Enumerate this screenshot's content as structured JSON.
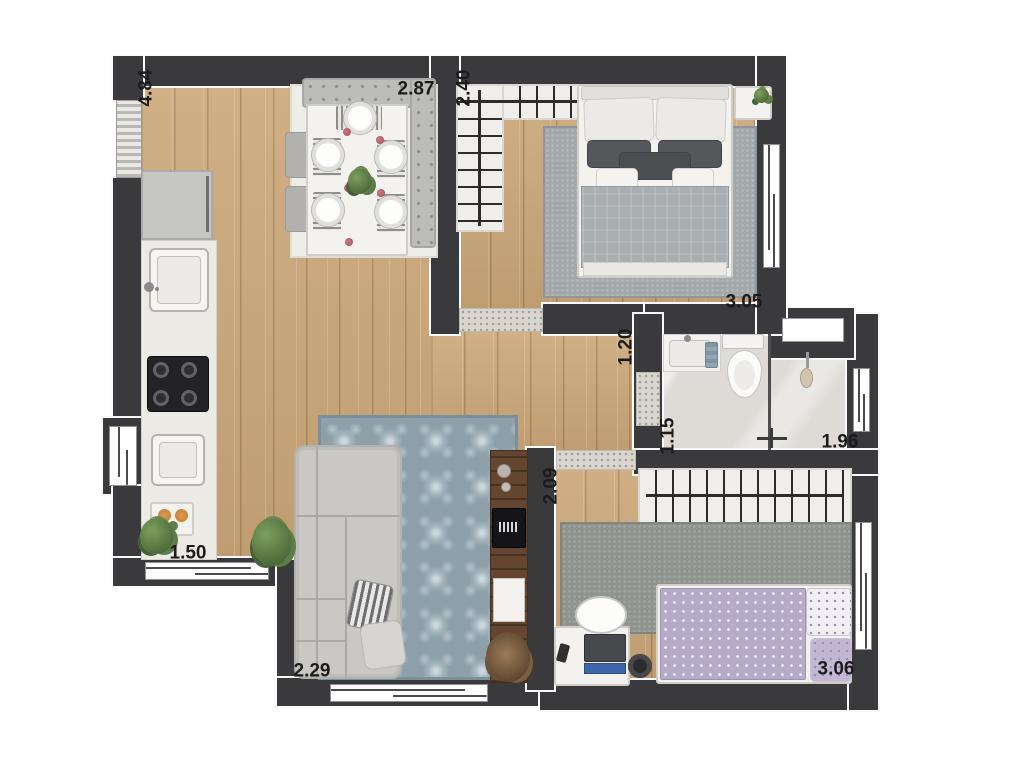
{
  "meta": {
    "type": "apartment floor plan render",
    "rooms": [
      "kitchen-dining",
      "bedroom-1",
      "bathroom",
      "living-room",
      "bedroom-2",
      "hall"
    ]
  },
  "colors": {
    "wall": "#3a3a3c",
    "wood": "#cda97c",
    "bath_floor": "#dedbd6",
    "rug_living": "#8da0aa",
    "rug_bed1": "#a3a8ab",
    "rug_bed2": "#90948f",
    "rug_dining": "#efede8",
    "sofa": "#c9c8c5",
    "tv_rack": "#64452f",
    "counter": "#eceae5",
    "bed2_blanket": "#b5aac7"
  },
  "dimensions": {
    "entry": "4.84",
    "dining": "2.87",
    "closet": "2.40",
    "bedroom1": "3.05",
    "hall": "1.20",
    "bathroom": "1.15",
    "shower": "1.96",
    "bedroom2_entry": "2.09",
    "kitchen": "1.50",
    "living": "2.29",
    "bedroom2": "3.06"
  }
}
